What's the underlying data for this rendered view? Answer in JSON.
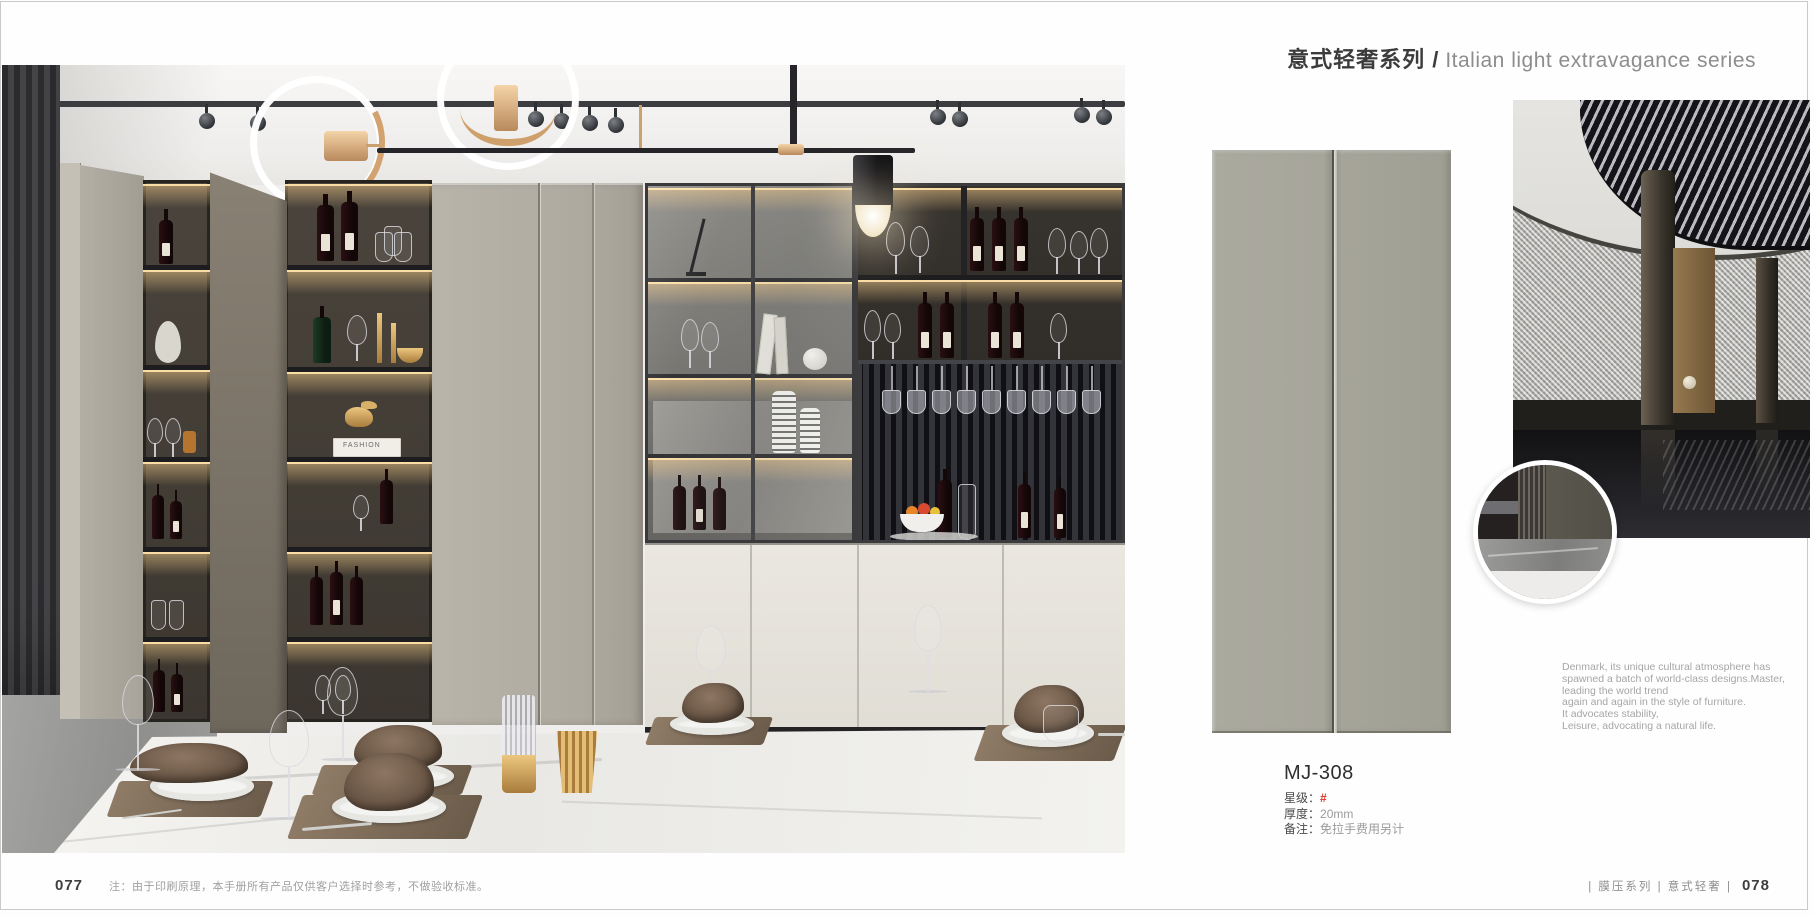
{
  "header": {
    "series_zh": "意式轻奢系列 /",
    "series_en": "Italian light extravagance series"
  },
  "product": {
    "code": "MJ-308",
    "specs": [
      {
        "label": "星级：",
        "value": "#"
      },
      {
        "label": "厚度：",
        "value": "20mm"
      },
      {
        "label": "备注：",
        "value": "免拉手费用另计"
      }
    ]
  },
  "description": {
    "lines": [
      "Denmark, its unique cultural atmosphere has",
      "spawned a batch of world-class designs.Master,",
      "leading the world trend",
      "again and again in the style of furniture.",
      "It advocates stability,",
      "Leisure, advocating a natural life."
    ]
  },
  "photo": {
    "book_spine": "FASHION"
  },
  "footer": {
    "page_left": "077",
    "note": "注：由于印刷原理，本手册所有产品仅供客户选择时参考，不做验收标准。",
    "series_tags": "|  膜压系列  |  意式轻奢  |",
    "page_right": "078"
  },
  "colors": {
    "panel_sample": "#a8a79b",
    "accent_red": "#d6372e",
    "brass": "#d3a271",
    "warm_glow": "#e9c48e"
  }
}
